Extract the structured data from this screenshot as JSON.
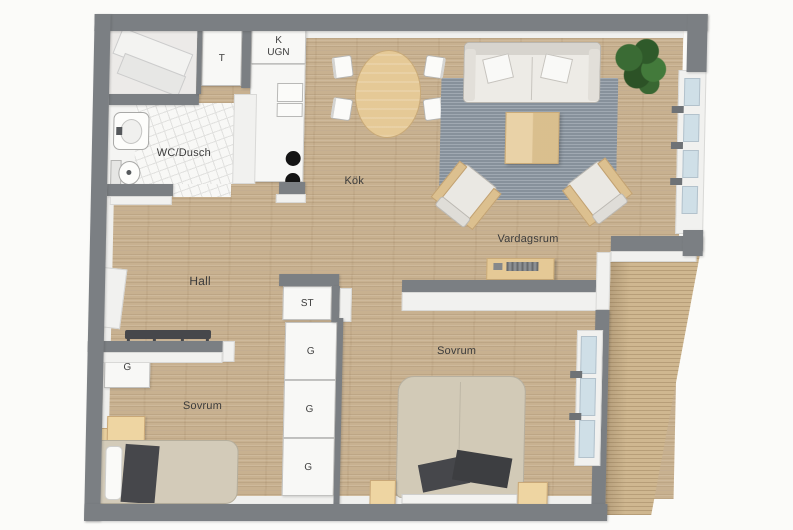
{
  "rooms": {
    "bathroom": {
      "label": "WC/Dusch"
    },
    "kitchen": {
      "label": "Kök"
    },
    "living_room": {
      "label": "Vardagsrum"
    },
    "hall": {
      "label": "Hall"
    },
    "bedroom_small": {
      "label": "Sovrum"
    },
    "bedroom_large": {
      "label": "Sovrum"
    }
  },
  "storage": {
    "dryer_cabinet": {
      "label": "T"
    },
    "cleaning_cabinet": {
      "label": "ST"
    },
    "wardrobe_small_bedroom": {
      "label": "G"
    },
    "wardrobe_top": {
      "label": "G"
    },
    "wardrobe_middle": {
      "label": "G"
    },
    "wardrobe_bottom": {
      "label": "G"
    }
  },
  "appliances": {
    "fridge_label": "K",
    "oven_label": "UGN"
  },
  "palette": {
    "wall": "#7b7f83",
    "wood_floor": "#c8b190",
    "balcony_deck": "#cfb790",
    "rug": "#939da7",
    "furniture_wood": "#e5c996",
    "textile_dark": "#46474b",
    "bed_linen": "#d2cab7",
    "window_glass": "#cfdfe7",
    "plant_green": "#35602f",
    "label_text": "#3b3b3b"
  }
}
